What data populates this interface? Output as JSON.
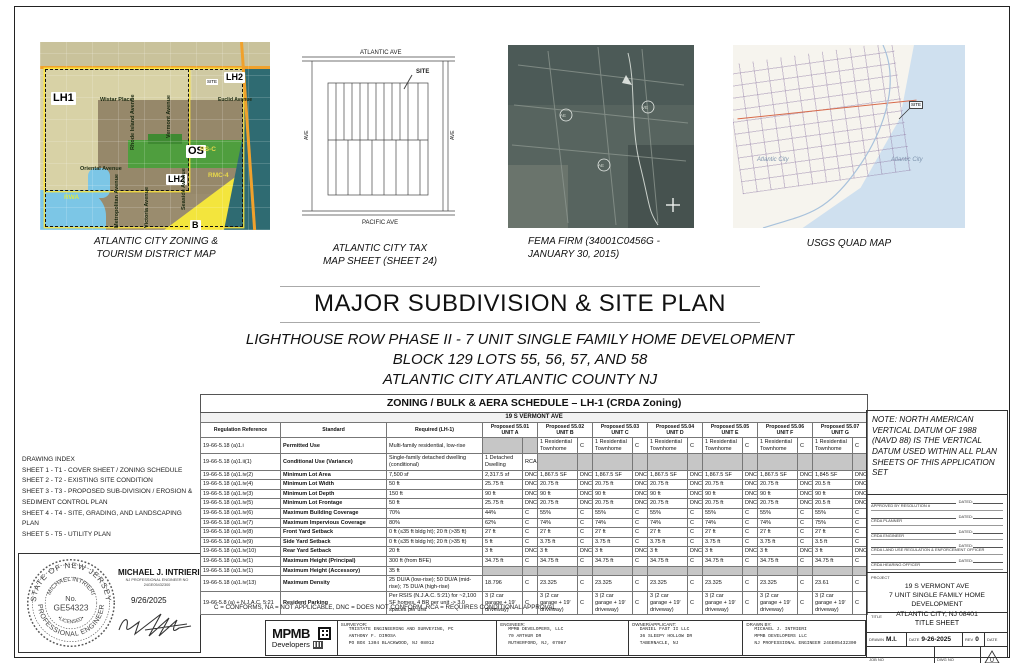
{
  "maps": {
    "zoning": {
      "caption": "ATLANTIC CITY ZONING &\nTOURISM DISTRICT MAP",
      "labels": {
        "lh1": "LH1",
        "lh2_top": "LH2",
        "lh2_mid": "LH2",
        "os": "OS",
        "b": "B",
        "rwa": "RWA",
        "rsc": "RS-C",
        "rmc4": "RMC-4",
        "site": "SITE",
        "wistar": "Wistar Place",
        "euclid": "Euclid Avenue",
        "rhode_island": "Rhode Island Avenue",
        "vermont": "Vermont Avenue",
        "oriental": "Oriental Avenue",
        "metropolitan": "Metropolitan Avenue",
        "victoria": "Victoria Avenue",
        "seaside": "Seaside Avenue"
      }
    },
    "tax": {
      "caption": "ATLANTIC CITY TAX\nMAP SHEET (SHEET 24)",
      "labels": {
        "top": "ATLANTIC  AVE",
        "bottom": "PACIFIC  AVE",
        "site": "SITE",
        "left": "AVE",
        "right": "AVE"
      }
    },
    "fema": {
      "caption": "FEMA FIRM (34001C0456G -\nJANUARY 30, 2015)"
    },
    "usgs": {
      "caption": "USGS QUAD MAP",
      "labels": {
        "site": "SITE",
        "city1": "Atlantic City",
        "city2": "Atlantic City"
      }
    }
  },
  "titles": {
    "main": "MAJOR SUBDIVISION & SITE PLAN",
    "sub1": "LIGHTHOUSE ROW PHASE II - 7 UNIT SINGLE FAMILY HOME DEVELOPMENT",
    "sub2": "BLOCK 129  LOTS 55, 56, 57, AND 58",
    "sub3": "ATLANTIC CITY ATLANTIC COUNTY NJ"
  },
  "drawing_index": {
    "title": "DRAWING INDEX",
    "items": [
      "SHEET 1 - T1 - COVER SHEET / ZONING SCHEDULE",
      "SHEET 2 - T2 - EXISTING SITE CONDITION",
      "SHEET 3 - T3 - PROPOSED SUB-DIVISION / EROSION & SEDIMENT CONTROL PLAN",
      "SHEET 4 - T4 - SITE, GRADING, AND LANDSCAPING PLAN",
      "SHEET 5 - T5 - UTILITY PLAN"
    ]
  },
  "seal": {
    "ring_top": "STATE OF NEW JERSEY",
    "ring_bottom": "PROFESSIONAL ENGINEER",
    "inner_name": "MICHAEL INTRIERI",
    "no_label": "No.",
    "license": "GE54323",
    "licensed": "•LICENSED•",
    "name": "MICHAEL J. INTRIERI",
    "sub1": "NJ PROFESSIONAL ENGINEER NO",
    "sub2": "24GE05432300",
    "date": "9/26/2025"
  },
  "zoning_table": {
    "title": "ZONING / BULK & AERA SCHEDULE – LH-1 (CRDA Zoning)",
    "address": "19 S VERMONT AVE",
    "col_headers": [
      "Regulation Reference",
      "Standard",
      "Required (LH-1)"
    ],
    "unit_headers": [
      "Proposed 55.01 UNIT A",
      "Proposed 55.02 UNIT B",
      "Proposed 55.03 UNIT C",
      "Proposed 55.04 UNIT D",
      "Proposed 55.05 UNIT E",
      "Proposed 55.06 UNIT F",
      "Proposed 55.07 UNIT G"
    ],
    "rows": [
      {
        "ref": "19-66-5.18 (a)1.i",
        "standard": "Permitted Use",
        "required": "Multi-family residential, low-rise",
        "cells": [
          null,
          [
            "1 Residential Townhome",
            "C"
          ],
          [
            "1 Residential Townhome",
            "C"
          ],
          [
            "1 Residential Townhome",
            "C"
          ],
          [
            "1 Residential Townhome",
            "C"
          ],
          [
            "1 Residential Townhome",
            "C"
          ],
          [
            "1 Residential Townhome",
            "C"
          ]
        ],
        "small": true
      },
      {
        "ref": "19-66-5.18 (a)1.ii(1)",
        "standard": "Conditional Use (Variance)",
        "required": "Single-family detached dwelling (conditional)",
        "cells": [
          [
            "1 Detached Dwelling",
            "RCA"
          ],
          null,
          null,
          null,
          null,
          null,
          null
        ],
        "small": true
      },
      {
        "ref": "19-66-5.18 (a)1.iv(2)",
        "standard": "Minimum Lot Area",
        "required": "7,500 sf",
        "cells": [
          [
            "2,317.5 sf",
            "DNC"
          ],
          [
            "1,867.5 SF",
            "DNC"
          ],
          [
            "1,867.5 SF",
            "DNC"
          ],
          [
            "1,867.5 SF",
            "DNC"
          ],
          [
            "1,867.5 SF",
            "DNC"
          ],
          [
            "1,867.5 SF",
            "DNC"
          ],
          [
            "1,845 SF",
            "DNC"
          ]
        ]
      },
      {
        "ref": "19-66-5.18 (a)1.iv(4)",
        "standard": "Minimum Lot Width",
        "required": "50 ft",
        "cells": [
          [
            "25.75 ft",
            "DNC"
          ],
          [
            "20.75 ft",
            "DNC"
          ],
          [
            "20.75 ft",
            "DNC"
          ],
          [
            "20.75 ft",
            "DNC"
          ],
          [
            "20.75 ft",
            "DNC"
          ],
          [
            "20.75 ft",
            "DNC"
          ],
          [
            "20.5 ft",
            "DNC"
          ]
        ]
      },
      {
        "ref": "19-66-5.18 (a)1.iv(3)",
        "standard": "Minimum Lot Depth",
        "required": "150 ft",
        "cells": [
          [
            "90 ft",
            "DNC"
          ],
          [
            "90 ft",
            "DNC"
          ],
          [
            "90 ft",
            "DNC"
          ],
          [
            "90 ft",
            "DNC"
          ],
          [
            "90 ft",
            "DNC"
          ],
          [
            "90 ft",
            "DNC"
          ],
          [
            "90 ft",
            "DNC"
          ]
        ]
      },
      {
        "ref": "19-66-5.18 (a)1.iv(5)",
        "standard": "Minimum Lot Frontage",
        "required": "50 ft",
        "cells": [
          [
            "25.75 ft",
            "DNC"
          ],
          [
            "20.75 ft",
            "DNC"
          ],
          [
            "20.75 ft",
            "DNC"
          ],
          [
            "20.75 ft",
            "DNC"
          ],
          [
            "20.75 ft",
            "DNC"
          ],
          [
            "20.75 ft",
            "DNC"
          ],
          [
            "20.5 ft",
            "DNC"
          ]
        ]
      },
      {
        "ref": "19-66-5.18 (a)1.iv(6)",
        "standard": "Maximum Building Coverage",
        "required": "70%",
        "cells": [
          [
            "44%",
            "C"
          ],
          [
            "55%",
            "C"
          ],
          [
            "55%",
            "C"
          ],
          [
            "55%",
            "C"
          ],
          [
            "55%",
            "C"
          ],
          [
            "55%",
            "C"
          ],
          [
            "55%",
            "C"
          ]
        ]
      },
      {
        "ref": "19-66-5.18 (a)1.iv(7)",
        "standard": "Maximum Impervious Coverage",
        "required": "80%",
        "cells": [
          [
            "62%",
            "C"
          ],
          [
            "74%",
            "C"
          ],
          [
            "74%",
            "C"
          ],
          [
            "74%",
            "C"
          ],
          [
            "74%",
            "C"
          ],
          [
            "74%",
            "C"
          ],
          [
            "75%",
            "C"
          ]
        ]
      },
      {
        "ref": "19-66-5.18 (a)1.iv(8)",
        "standard": "Front Yard Setback",
        "required": "0 ft (≤35 ft bldg ht); 20 ft (>35 ft)",
        "cells": [
          [
            "27 ft",
            "C"
          ],
          [
            "27 ft",
            "C"
          ],
          [
            "27 ft",
            "C"
          ],
          [
            "27 ft",
            "C"
          ],
          [
            "27 ft",
            "C"
          ],
          [
            "27 ft",
            "C"
          ],
          [
            "27 ft",
            "C"
          ]
        ]
      },
      {
        "ref": "19-66-5.18 (a)1.iv(9)",
        "standard": "Side Yard Setback",
        "required": "0 ft (≤35 ft bldg ht); 20 ft (>35 ft)",
        "cells": [
          [
            "5 ft",
            "C"
          ],
          [
            "3.75 ft",
            "C"
          ],
          [
            "3.75 ft",
            "C"
          ],
          [
            "3.75 ft",
            "C"
          ],
          [
            "3.75 ft",
            "C"
          ],
          [
            "3.75 ft",
            "C"
          ],
          [
            "3.5 ft",
            "C"
          ]
        ]
      },
      {
        "ref": "19-66-5.18 (a)1.iv(10)",
        "standard": "Rear Yard Setback",
        "required": "20 ft",
        "cells": [
          [
            "3 ft",
            "DNC"
          ],
          [
            "3 ft",
            "DNC"
          ],
          [
            "3 ft",
            "DNC"
          ],
          [
            "3 ft",
            "DNC"
          ],
          [
            "3 ft",
            "DNC"
          ],
          [
            "3 ft",
            "DNC"
          ],
          [
            "3 ft",
            "DNC"
          ]
        ]
      },
      {
        "ref": "19-66-5.18 (a)1.iv(1)",
        "standard": "Maximum Height (Principal)",
        "required": "300 ft (from BFE)",
        "cells": [
          [
            "34.75 ft",
            "C"
          ],
          [
            "34.75 ft",
            "C"
          ],
          [
            "34.75 ft",
            "C"
          ],
          [
            "34.75 ft",
            "C"
          ],
          [
            "34.75 ft",
            "C"
          ],
          [
            "34.75 ft",
            "C"
          ],
          [
            "34.75 ft",
            "C"
          ]
        ]
      },
      {
        "ref": "19-66-5.18 (a)1.iv(1)",
        "standard": "Maximum Height (Accessory)",
        "required": "35 ft",
        "cells": [
          null,
          null,
          null,
          null,
          null,
          null,
          null
        ]
      },
      {
        "ref": "19-66-5.18 (a)1.iv(13)",
        "standard": "Maximum Density",
        "required": "25 DU/A (low-rise); 50 DU/A (mid-rise); 75 DU/A (high-rise)",
        "cells": [
          [
            "18.796",
            "C"
          ],
          [
            "23.325",
            "C"
          ],
          [
            "23.325",
            "C"
          ],
          [
            "23.325",
            "C"
          ],
          [
            "23.325",
            "C"
          ],
          [
            "23.325",
            "C"
          ],
          [
            "23.61",
            "C"
          ]
        ]
      },
      {
        "ref": "19-66-5.8 (a) + N.J.A.C. 5:21",
        "standard": "Resident Parking",
        "required": "Per RSIS (N.J.A.C. 5:21) for ~2,100 SF homes, 4 BR per unit -> 3.0 spaces per unit",
        "cells": [
          [
            "3 (2 car garage + 19' driveway)",
            "C"
          ],
          [
            "3 (2 car garage + 19' driveway)",
            "C"
          ],
          [
            "3 (2 car garage + 19' driveway)",
            "C"
          ],
          [
            "3 (2 car garage + 19' driveway)",
            "C"
          ],
          [
            "3 (2 car garage + 19' driveway)",
            "C"
          ],
          [
            "3 (2 car garage + 19' driveway)",
            "C"
          ],
          [
            "3 (2 car garage + 19' driveway)",
            "C"
          ]
        ],
        "small": true
      }
    ],
    "footnote": "C = CONFORMS, NA = NOT APPLICABLE, DNC = DOES NOT CONFORM, RCA = REQUIRES CONDITIONAL APPROVAL"
  },
  "note": "NOTE: NORTH AMERICAN VERTICAL DATUM OF 1988 (NAVD 88) IS THE VERTICAL DATUM USED WITHIN ALL PLAN SHEETS OF THIS APPLICATION SET",
  "approvals": {
    "dated_label": "DATED:",
    "items": [
      "APPROVED BY RESOLUTION #",
      "CRDA PLANNER",
      "CRDA ENGINEER",
      "CRDA LAND USE REGULATION & ENFORCEMENT OFFICER",
      "CRDA HEARING OFFICER"
    ]
  },
  "project": {
    "tag": "PROJECT",
    "lines": [
      "19 S VERMONT AVE",
      "7 UNIT SINGLE FAMILY HOME DEVELOPMENT",
      "ATLANTIC CITY, NJ 08401"
    ]
  },
  "title_block": {
    "tag": "TITLE",
    "value": "TITLE SHEET",
    "drawn_label": "DRAWN",
    "drawn": "M.I.",
    "date_label": "DATE",
    "date": "9-26-2025",
    "rev_label": "REV",
    "rev": "0",
    "date2_label": "DATE",
    "job_label": "JOB NO",
    "job": "202505",
    "dwg_label": "DWG NO",
    "dwg": "T1",
    "delta": "0"
  },
  "bottom_bar": {
    "logo": {
      "name": "MPMB",
      "sub": "Developers"
    },
    "surveyor": {
      "label": "SURVEYOR:",
      "lines": [
        "TRISTATE ENGINEERING AND SURVEYING, PC",
        "ANTHONY F. DIROSA",
        "PO BOX 1304 BLACKWOOD, NJ 08012"
      ]
    },
    "engineer": {
      "label": "ENGINEER:",
      "lines": [
        "MPMB DEVELOPERS, LLC",
        "70 ARTHUR DR",
        "RUTHERFORD, NJ, 07087"
      ]
    },
    "owner": {
      "label": "OWNER/APPLICANT:",
      "lines": [
        "DANIEL FAST II LLC",
        "36 SLEEPY HOLLOW DR",
        "TABERNACLE, NJ"
      ]
    },
    "drawn_by": {
      "label": "DRAWN BY:",
      "lines": [
        "MICHAEL J. INTRIERI",
        "MPMB DEVELOPERS LLC",
        "NJ PROFESSIONAL ENGINEER 24GE05432300"
      ]
    }
  }
}
